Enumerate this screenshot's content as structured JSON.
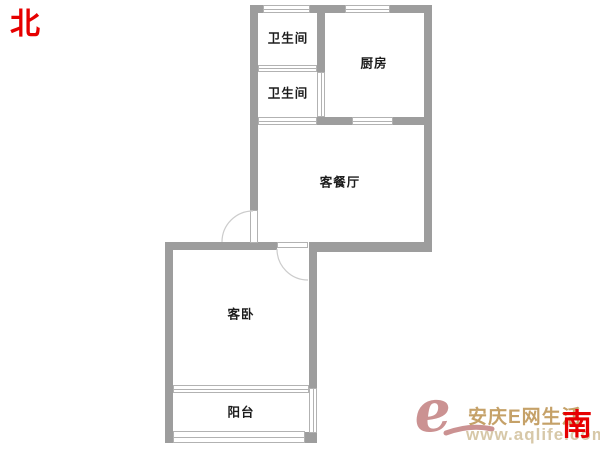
{
  "compass": {
    "north_label": "北",
    "south_label": "南",
    "color": "#e60000"
  },
  "floorplan": {
    "rooms": [
      {
        "id": "bathroom-1",
        "label": "卫生间"
      },
      {
        "id": "bathroom-2",
        "label": "卫生间"
      },
      {
        "id": "kitchen",
        "label": "厨房"
      },
      {
        "id": "living-dining",
        "label": "客餐厅"
      },
      {
        "id": "bedroom",
        "label": "客卧"
      },
      {
        "id": "balcony",
        "label": "阳台"
      }
    ],
    "colors": {
      "wall": "#9d9d9d",
      "window_line": "#b2b2b2",
      "door_arc": "#cccccc",
      "label_text": "#1c1c1c"
    }
  },
  "watermark": {
    "logo_glyph": "e",
    "site_name": "安庆E网生活",
    "url": "www.aqlife.com",
    "logo_color": "#cb9292",
    "site_name_color": "#c5a168",
    "url_color": "#d7c8a8"
  }
}
